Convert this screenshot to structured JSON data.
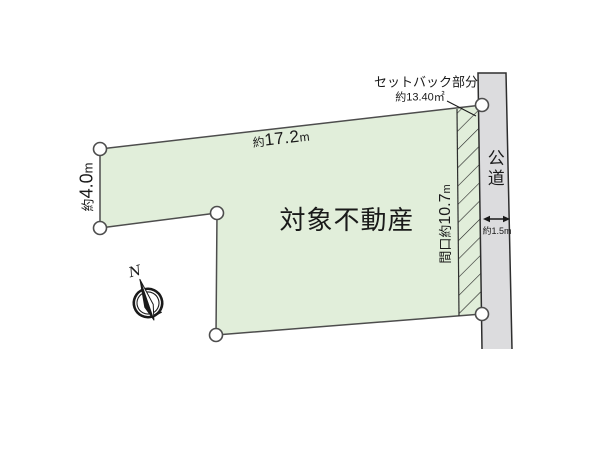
{
  "diagram": {
    "property_label": "対象不動産",
    "top_dimension": {
      "prefix": "約",
      "value": "17.2",
      "unit": "m"
    },
    "left_dimension": {
      "prefix": "約",
      "value": "4.0",
      "unit": "m"
    },
    "frontage_dimension": {
      "prefix": "間口約",
      "value": "10.7",
      "unit": "m"
    },
    "setback": {
      "label": "セットバック部分",
      "area": "約13.40㎡"
    },
    "road": {
      "label": "公道",
      "width": "約1.5m"
    },
    "compass": {
      "north": "N"
    }
  },
  "colors": {
    "parcel-fill": "#e1eeda",
    "road-fill": "#dcdcde",
    "outline": "#4d4d4d",
    "road-border": "#2e2e2e",
    "hatch": "#222222",
    "ink": "#1a1a1a"
  }
}
